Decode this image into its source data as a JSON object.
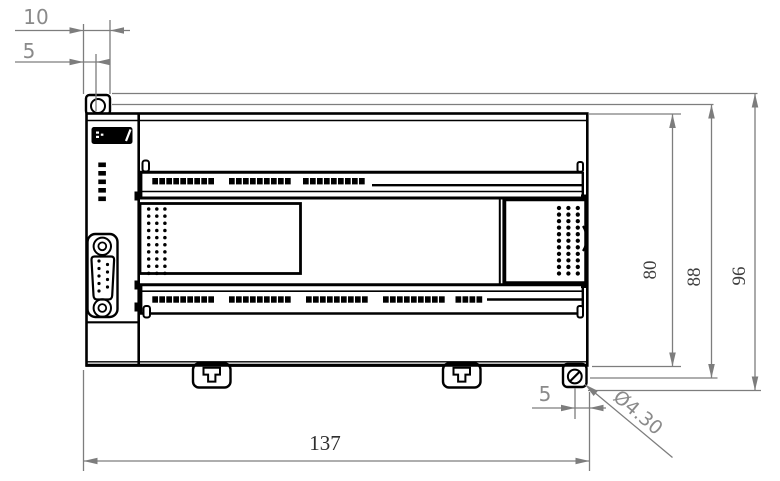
{
  "drawing": {
    "type": "mechanical-dimension-drawing",
    "subject": "PLC controller module front view",
    "colors": {
      "outline": "#000000",
      "dimension_lines": "#7d7d7d",
      "background": "#ffffff"
    },
    "dimensions": {
      "top_ear_width": "10",
      "top_hole_offset": "5",
      "body_height": "80",
      "mounting_hole_spacing": "88",
      "overall_height": "96",
      "bottom_hole_offset": "5",
      "mounting_hole_diameter": "Ø4.30",
      "overall_width": "137"
    }
  }
}
